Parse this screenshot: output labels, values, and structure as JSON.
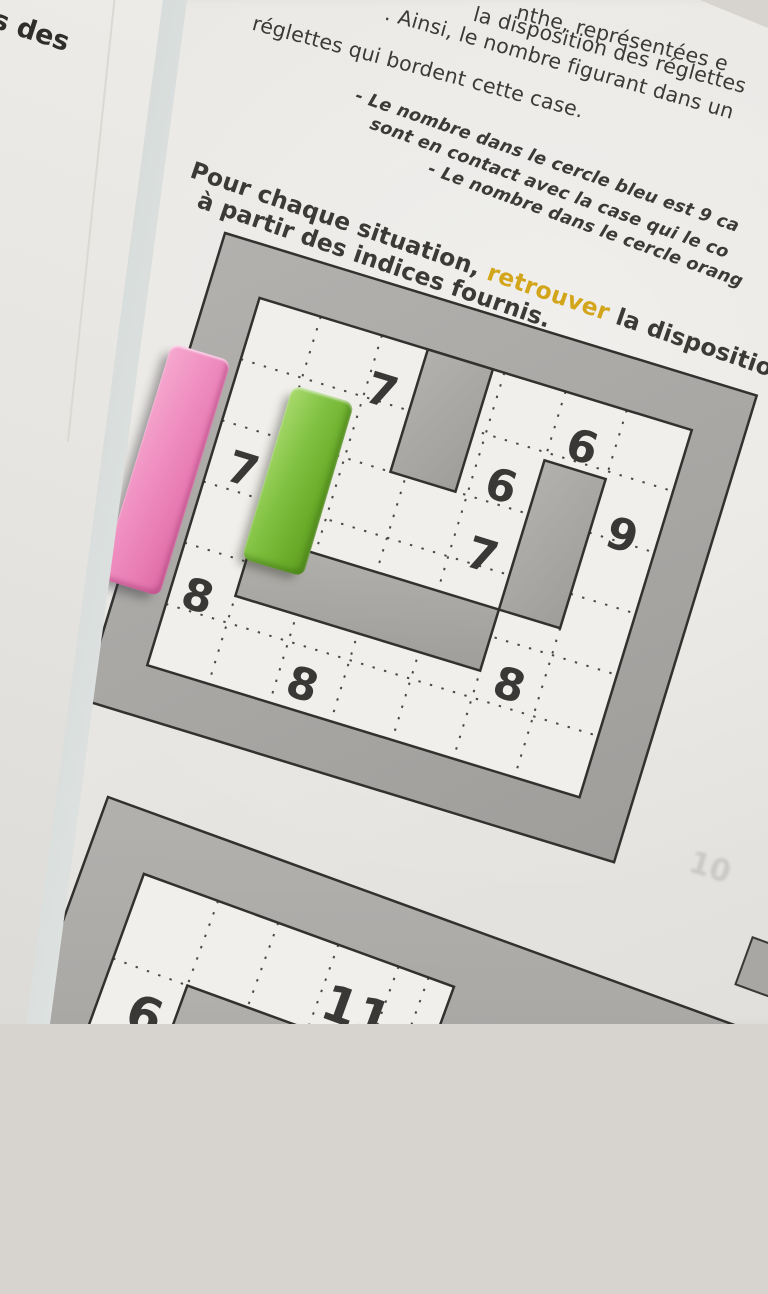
{
  "scene": {
    "description": "Photo of a printed French math worksheet with a number labyrinth and two Cuisenaire rods",
    "colors": {
      "highlight": "#d2a51a",
      "text": "#3b3a37",
      "wall_gray": "#aaa8a5",
      "paper": "#e9e7e3",
      "pink_rod": "#ee8abc",
      "green_rod": "#7cbd3c"
    }
  },
  "left_sheet": {
    "word_highlight": "s",
    "word_rest": " des",
    "frag_dark": "n",
    "frag_yellow": "s"
  },
  "page": {
    "intro_lines": [
      "nthe, représentées e",
      "la disposition des réglettes",
      ". Ainsi, le nombre figurant dans un",
      "réglettes qui bordent cette case."
    ],
    "bullet_lines": [
      "- Le nombre dans le cercle bleu est 9 ca",
      "sont en contact avec la case qui le co",
      "- Le nombre dans le cercle orang"
    ],
    "instruction": {
      "part1": "Pour chaque situation, ",
      "highlight": "retrouver",
      "part2": " la disposition d",
      "line2": "à partir des indices fournis."
    },
    "bleedthrough": "10"
  },
  "maze1": {
    "clues": [
      {
        "v": "7"
      },
      {
        "v": "6"
      },
      {
        "v": "6"
      },
      {
        "v": "9"
      },
      {
        "v": "7"
      },
      {
        "v": "7"
      },
      {
        "v": "8"
      },
      {
        "v": "8"
      },
      {
        "v": "8"
      }
    ]
  },
  "maze2": {
    "clues": [
      {
        "v": "6"
      },
      {
        "v": "11"
      }
    ]
  }
}
